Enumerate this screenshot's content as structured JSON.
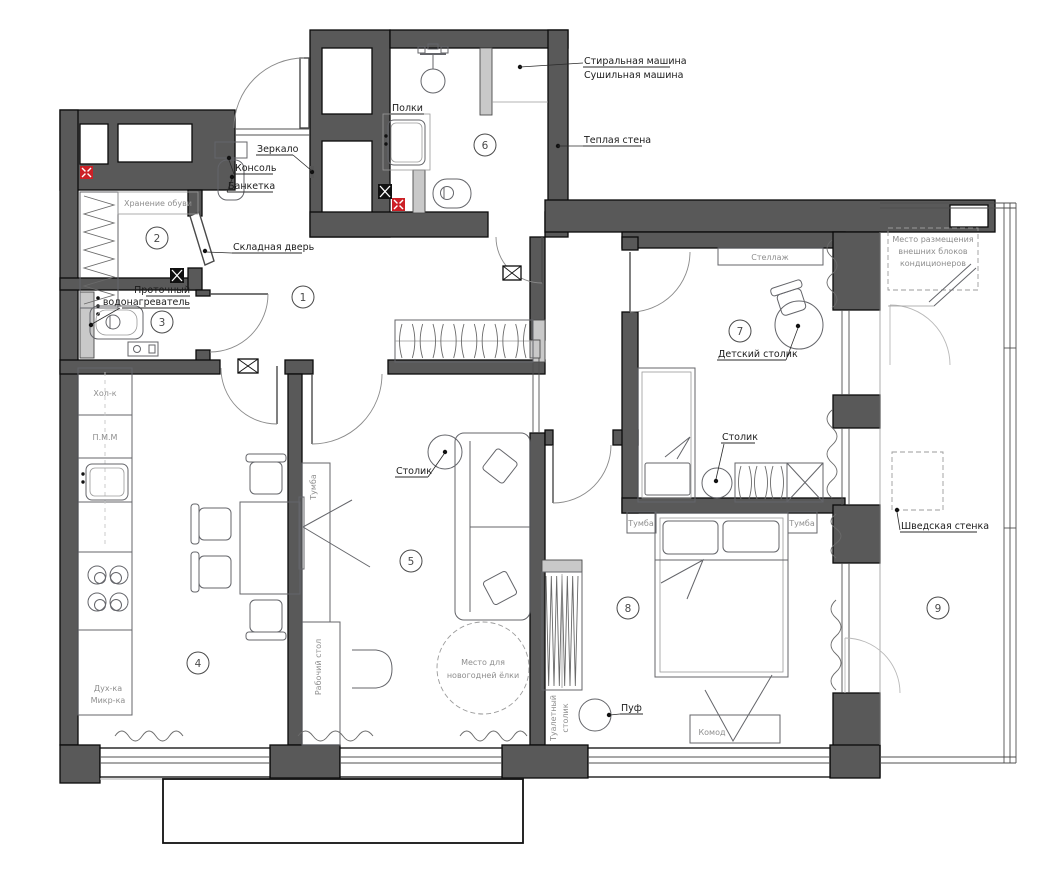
{
  "plan": {
    "rooms": [
      {
        "num": "1"
      },
      {
        "num": "2"
      },
      {
        "num": "3"
      },
      {
        "num": "4"
      },
      {
        "num": "5"
      },
      {
        "num": "6"
      },
      {
        "num": "7"
      },
      {
        "num": "8"
      },
      {
        "num": "9"
      }
    ],
    "callouts": {
      "washer": "Стиральная машина",
      "dryer": "Сушильная машина",
      "warm_wall": "Теплая стена",
      "shelves": "Полки",
      "mirror": "Зеркало",
      "console": "Консоль",
      "bench": "Банкетка",
      "folding_door": "Складная дверь",
      "heater_line1": "Проточный",
      "heater_line2": "водонагреватель",
      "table_living": "Столик",
      "kids_table": "Детский столик",
      "table_kids_room": "Столик",
      "pouf": "Пуф",
      "swedish_wall": "Шведская стенка"
    },
    "furniture": {
      "shoe_storage": "Хранение обуви",
      "fridge": "Хол-к",
      "dishwasher": "П.М.М",
      "oven": "Дух-ка",
      "microwave": "Микр-ка",
      "tv_stand": "Тумба",
      "desk": "Рабочий стол",
      "tree_line1": "Место для",
      "tree_line2": "новогодней ёлки",
      "shelving": "Стеллаж",
      "nightstand_left": "Тумба",
      "nightstand_right": "Тумба",
      "dresser": "Комод",
      "vanity_line1": "Туалетный",
      "vanity_line2": "столик",
      "ac_line1": "Место размещения",
      "ac_line2": "внешних блоков",
      "ac_line3": "кондиционеров"
    },
    "colors": {
      "wall": "#595959",
      "light_fill": "#c9c9c9",
      "vent_red": "#cc2026",
      "line": "#1c1c1c",
      "gray_text": "#8e8e8e"
    }
  }
}
